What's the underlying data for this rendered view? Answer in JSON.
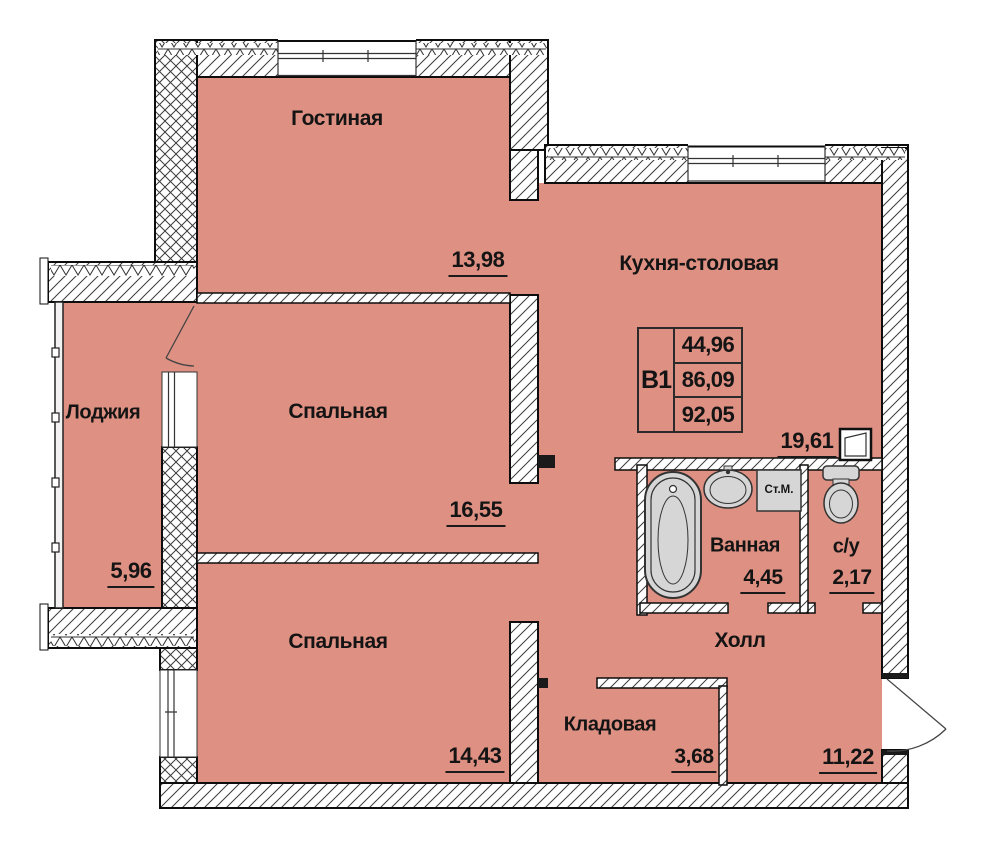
{
  "plan": {
    "unit": {
      "code": "В1",
      "values": [
        "44,96",
        "86,09",
        "92,05"
      ]
    },
    "rooms": [
      {
        "id": "gostinaya",
        "name": "Гостиная",
        "area": "13,98"
      },
      {
        "id": "kitchen",
        "name": "Кухня-столовая",
        "area": "19,61"
      },
      {
        "id": "bedroom-1",
        "name": "Спальная",
        "area": "16,55"
      },
      {
        "id": "bedroom-2",
        "name": "Спальная",
        "area": "14,43"
      },
      {
        "id": "loggia",
        "name": "Лоджия",
        "area": "5,96"
      },
      {
        "id": "bathroom",
        "name": "Ванная",
        "area": "4,45"
      },
      {
        "id": "wc",
        "name": "с/у",
        "area": "2,17"
      },
      {
        "id": "hall",
        "name": "Холл",
        "area": "11,22"
      },
      {
        "id": "storage",
        "name": "Кладовая",
        "area": "3,68"
      }
    ],
    "fixtures": {
      "washing_machine": "Ст.М."
    },
    "colors": {
      "room_fill": "#de9082",
      "wall_outline": "#111111",
      "fixture_fill": "#d6d6d6"
    }
  }
}
